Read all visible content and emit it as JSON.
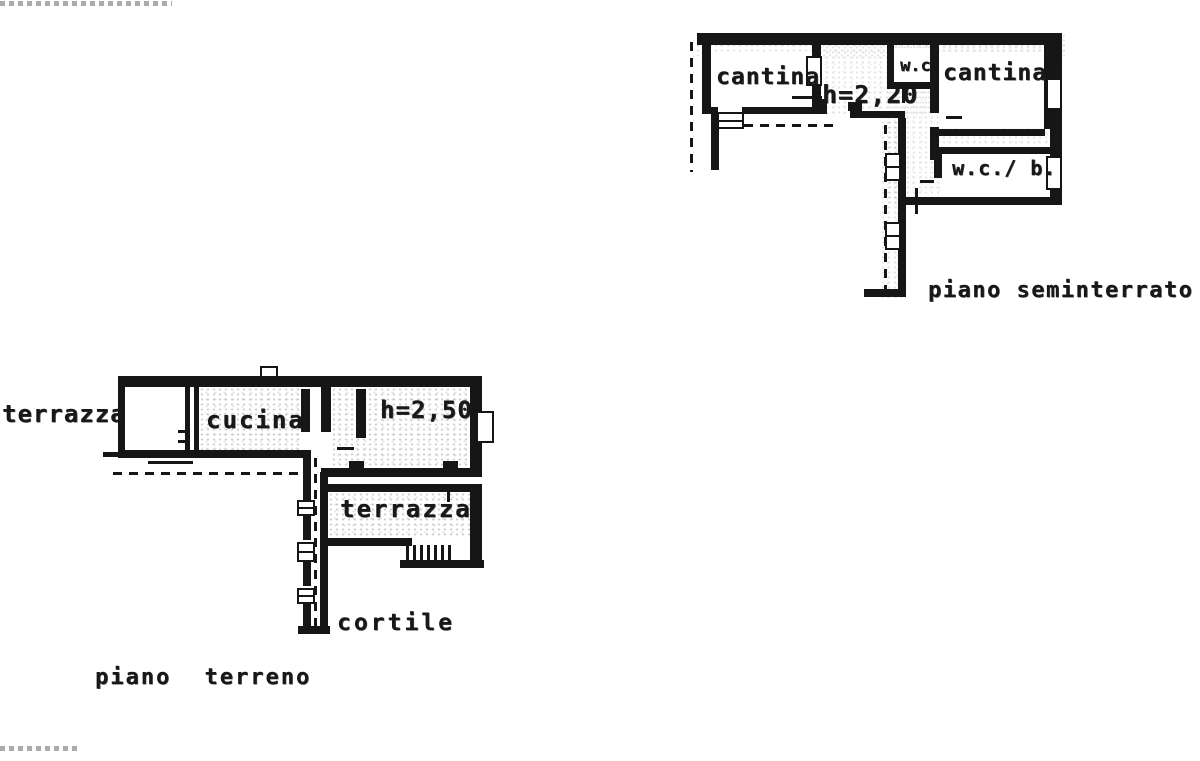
{
  "colors": {
    "ink": "#161616",
    "paper": "#ffffff"
  },
  "seminterrato": {
    "caption": "piano seminterrato",
    "height_label": "h=2,20",
    "room_cantina_left": "cantina",
    "room_wc": "w.c.",
    "room_cantina_right": "cantina",
    "room_wc_bath": "w.c./ b."
  },
  "terreno": {
    "caption": "piano terreno",
    "height_label": "h=2,50",
    "room_terrazza_left": "terrazza",
    "room_cucina": "cucina",
    "room_terrazza_inner": "terrazza",
    "room_cortile": "cortile"
  }
}
